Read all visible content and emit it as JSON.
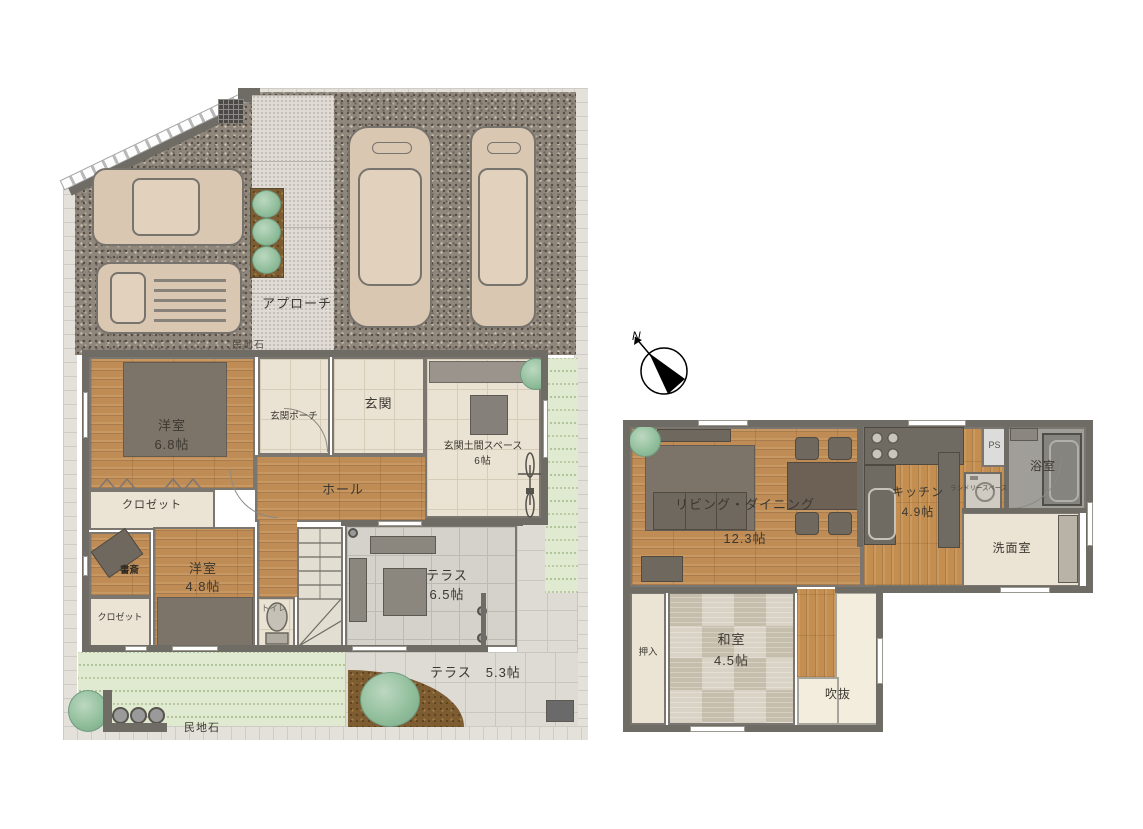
{
  "floor1": {
    "site": {
      "approach": "アプローチ",
      "stone_top": "民地石",
      "stone_bottom": "民地石"
    },
    "rooms": {
      "western_room_1": {
        "name": "洋室",
        "size": "6.8帖"
      },
      "closet_1": {
        "name": "クロゼット"
      },
      "entrance_porch": {
        "name": "玄関ポーチ"
      },
      "entrance": {
        "name": "玄関"
      },
      "entrance_doma": {
        "name": "玄関土間スペース",
        "size": "6帖"
      },
      "hall": {
        "name": "ホール"
      },
      "study": {
        "name": "書斎"
      },
      "western_room_2": {
        "name": "洋室",
        "size": "4.8帖"
      },
      "closet_2": {
        "name": "クロゼット"
      },
      "toilet": {
        "name": "トイレ"
      },
      "terrace_1": {
        "name": "テラス",
        "size": "6.5帖"
      },
      "terrace_2": {
        "name": "テラス　5.3帖"
      }
    }
  },
  "compass": {
    "north": "N"
  },
  "floor2": {
    "rooms": {
      "living_dining": {
        "name": "リビング・ダイニング",
        "size": "12.3帖"
      },
      "kitchen": {
        "name": "キッチン",
        "size": "4.9帖"
      },
      "ps": {
        "name": "PS"
      },
      "laundry": {
        "name": "ランドリースペース"
      },
      "bath": {
        "name": "浴室"
      },
      "washroom": {
        "name": "洗面室"
      },
      "japanese_room": {
        "name": "和室",
        "size": "4.5帖"
      },
      "oshiire": {
        "name": "押入"
      },
      "void": {
        "name": "吹抜"
      }
    }
  },
  "colors": {
    "wall": "#6f6c66",
    "wood": "#c08c55",
    "tatami": "#d0c9bb",
    "lawn": "#e0ead0",
    "gravel": "#8f867c"
  }
}
